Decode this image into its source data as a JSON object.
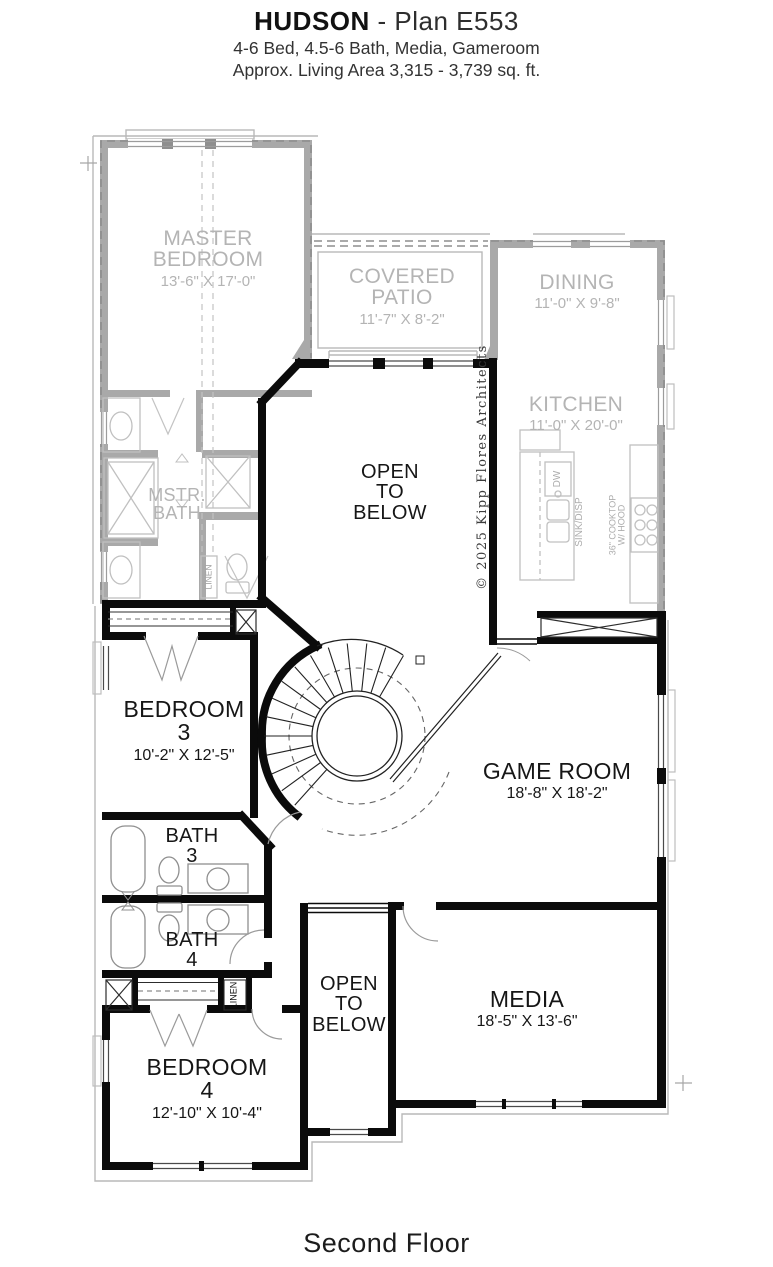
{
  "header": {
    "title_bold": "HUDSON",
    "title_rest": " - Plan E553",
    "subtitle1": "4-6 Bed, 4.5-6 Bath, Media, Gameroom",
    "subtitle2": "Approx. Living Area 3,315 - 3,739 sq. ft."
  },
  "footer": {
    "label": "Second Floor"
  },
  "copyright": "© 2025 Kipp Flores Architects",
  "rooms": {
    "master_bedroom": {
      "line1": "MASTER",
      "line2": "BEDROOM",
      "dims": "13'-6\" X 17'-0\""
    },
    "covered_patio": {
      "line1": "COVERED",
      "line2": "PATIO",
      "dims": "11'-7\" X 8'-2\""
    },
    "dining": {
      "line1": "DINING",
      "dims": "11'-0\" X 9'-8\""
    },
    "kitchen": {
      "line1": "KITCHEN",
      "dims": "11'-0\" X 20'-0\""
    },
    "mstr_bath": {
      "line1": "MSTR.",
      "line2": "BATH"
    },
    "open_to_below_upper": {
      "line1": "OPEN",
      "line2": "TO",
      "line3": "BELOW"
    },
    "bedroom_3": {
      "line1": "BEDROOM",
      "line2": "3",
      "dims": "10'-2\" X 12'-5\""
    },
    "game_room": {
      "line1": "GAME ROOM",
      "dims": "18'-8\" X 18'-2\""
    },
    "bath_3": {
      "line1": "BATH",
      "line2": "3"
    },
    "bath_4": {
      "line1": "BATH",
      "line2": "4"
    },
    "open_to_below_lower": {
      "line1": "OPEN",
      "line2": "TO",
      "line3": "BELOW"
    },
    "media": {
      "line1": "MEDIA",
      "dims": "18'-5\" X 13'-6\""
    },
    "bedroom_4": {
      "line1": "BEDROOM",
      "line2": "4",
      "dims": "12'-10\" X 10'-4\""
    }
  },
  "fixture_labels": {
    "linen_master": "LINEN",
    "linen_hall": "LINEN",
    "dw": "DW",
    "sink_disp": "SINK/DISP",
    "cooktop_line1": "36\" COOKTOP",
    "cooktop_line2": "W/ HOOD"
  },
  "colors": {
    "below_floor_gray": "#a9a9a9",
    "label_gray": "#b4b4b4",
    "wall_black": "#0b0b0b"
  }
}
